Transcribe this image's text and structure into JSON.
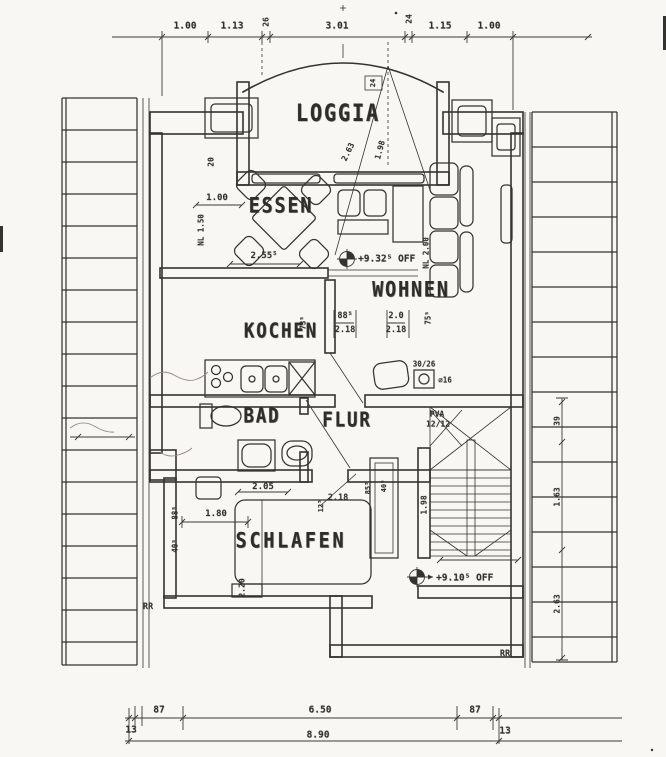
{
  "rooms": {
    "loggia": "LOGGIA",
    "essen": "ESSEN",
    "wohnen": "WOHNEN",
    "kochen": "KOCHEN",
    "bad": "BAD",
    "flur": "FLUR",
    "schlafen": "SCHLAFEN"
  },
  "elevations": {
    "living": "+9.32⁵ OFF",
    "stair": "+9.10⁵ OFF"
  },
  "dims": {
    "top": {
      "d1": "1.00",
      "d2": "1.13",
      "d3": "3.01",
      "d4": "1.15",
      "d5": "1.00"
    },
    "bottom": {
      "left13": "13",
      "left87": "87",
      "mid": "6.50",
      "right87": "87",
      "right13": "13",
      "total": "8.90"
    }
  },
  "annotations": [
    {
      "text": "26",
      "x": 266,
      "y": 22,
      "rot": -90,
      "size": 8
    },
    {
      "text": "24",
      "x": 409,
      "y": 19,
      "rot": -90,
      "size": 8
    },
    {
      "text": "24",
      "x": 373,
      "y": 83,
      "rot": -90,
      "size": 7
    },
    {
      "text": "20",
      "x": 211,
      "y": 162,
      "rot": -90,
      "size": 8
    },
    {
      "text": "1.00",
      "x": 217,
      "y": 198,
      "rot": 0,
      "size": 9
    },
    {
      "text": "NL 1.50",
      "x": 201,
      "y": 230,
      "rot": -90,
      "size": 7.5
    },
    {
      "text": "2.55⁵",
      "x": 264,
      "y": 256,
      "rot": 0,
      "size": 9
    },
    {
      "text": "2.63",
      "x": 348,
      "y": 152,
      "rot": -64,
      "size": 8
    },
    {
      "text": "1.98",
      "x": 380,
      "y": 150,
      "rot": -75,
      "size": 8
    },
    {
      "text": "NL 2.00",
      "x": 426,
      "y": 253,
      "rot": -90,
      "size": 7.5
    },
    {
      "text": "73⁵",
      "x": 303,
      "y": 323,
      "rot": -90,
      "size": 7.5
    },
    {
      "text": "88⁵",
      "x": 345,
      "y": 316,
      "rot": 0,
      "size": 8.5
    },
    {
      "text": "2.18",
      "x": 345,
      "y": 330,
      "rot": 0,
      "size": 8.5
    },
    {
      "text": "2.0",
      "x": 396,
      "y": 316,
      "rot": 0,
      "size": 8.5
    },
    {
      "text": "2.18",
      "x": 396,
      "y": 330,
      "rot": 0,
      "size": 8.5
    },
    {
      "text": "75⁵",
      "x": 428,
      "y": 318,
      "rot": -90,
      "size": 7.5
    },
    {
      "text": "30/26",
      "x": 424,
      "y": 364,
      "rot": 0,
      "size": 7.5
    },
    {
      "text": "∅16",
      "x": 445,
      "y": 380,
      "rot": 0,
      "size": 7.5
    },
    {
      "text": "PVA",
      "x": 437,
      "y": 414,
      "rot": 0,
      "size": 8
    },
    {
      "text": "12/12",
      "x": 438,
      "y": 424,
      "rot": 0,
      "size": 8
    },
    {
      "text": "1.98",
      "x": 424,
      "y": 505,
      "rot": -90,
      "size": 8
    },
    {
      "text": "2.05",
      "x": 263,
      "y": 487,
      "rot": 0,
      "size": 9
    },
    {
      "text": "2.18",
      "x": 338,
      "y": 498,
      "rot": 0,
      "size": 8.5
    },
    {
      "text": "12⁵",
      "x": 321,
      "y": 506,
      "rot": -90,
      "size": 7
    },
    {
      "text": "85⁵",
      "x": 368,
      "y": 488,
      "rot": -90,
      "size": 7
    },
    {
      "text": "40⁵",
      "x": 384,
      "y": 486,
      "rot": -90,
      "size": 7
    },
    {
      "text": "1.80",
      "x": 216,
      "y": 514,
      "rot": 0,
      "size": 9
    },
    {
      "text": "88⁵",
      "x": 175,
      "y": 513,
      "rot": -90,
      "size": 7.5
    },
    {
      "text": "40⁵",
      "x": 175,
      "y": 546,
      "rot": -90,
      "size": 7.5
    },
    {
      "text": "2.20",
      "x": 242,
      "y": 588,
      "rot": -90,
      "size": 8
    },
    {
      "text": "39",
      "x": 557,
      "y": 421,
      "rot": -90,
      "size": 8
    },
    {
      "text": "1.63",
      "x": 557,
      "y": 497,
      "rot": -90,
      "size": 8
    },
    {
      "text": "2.63",
      "x": 557,
      "y": 604,
      "rot": -90,
      "size": 8
    },
    {
      "text": "RR",
      "x": 148,
      "y": 607,
      "rot": 0,
      "size": 8.5
    },
    {
      "text": "RR",
      "x": 505,
      "y": 654,
      "rot": 0,
      "size": 8.5
    }
  ]
}
